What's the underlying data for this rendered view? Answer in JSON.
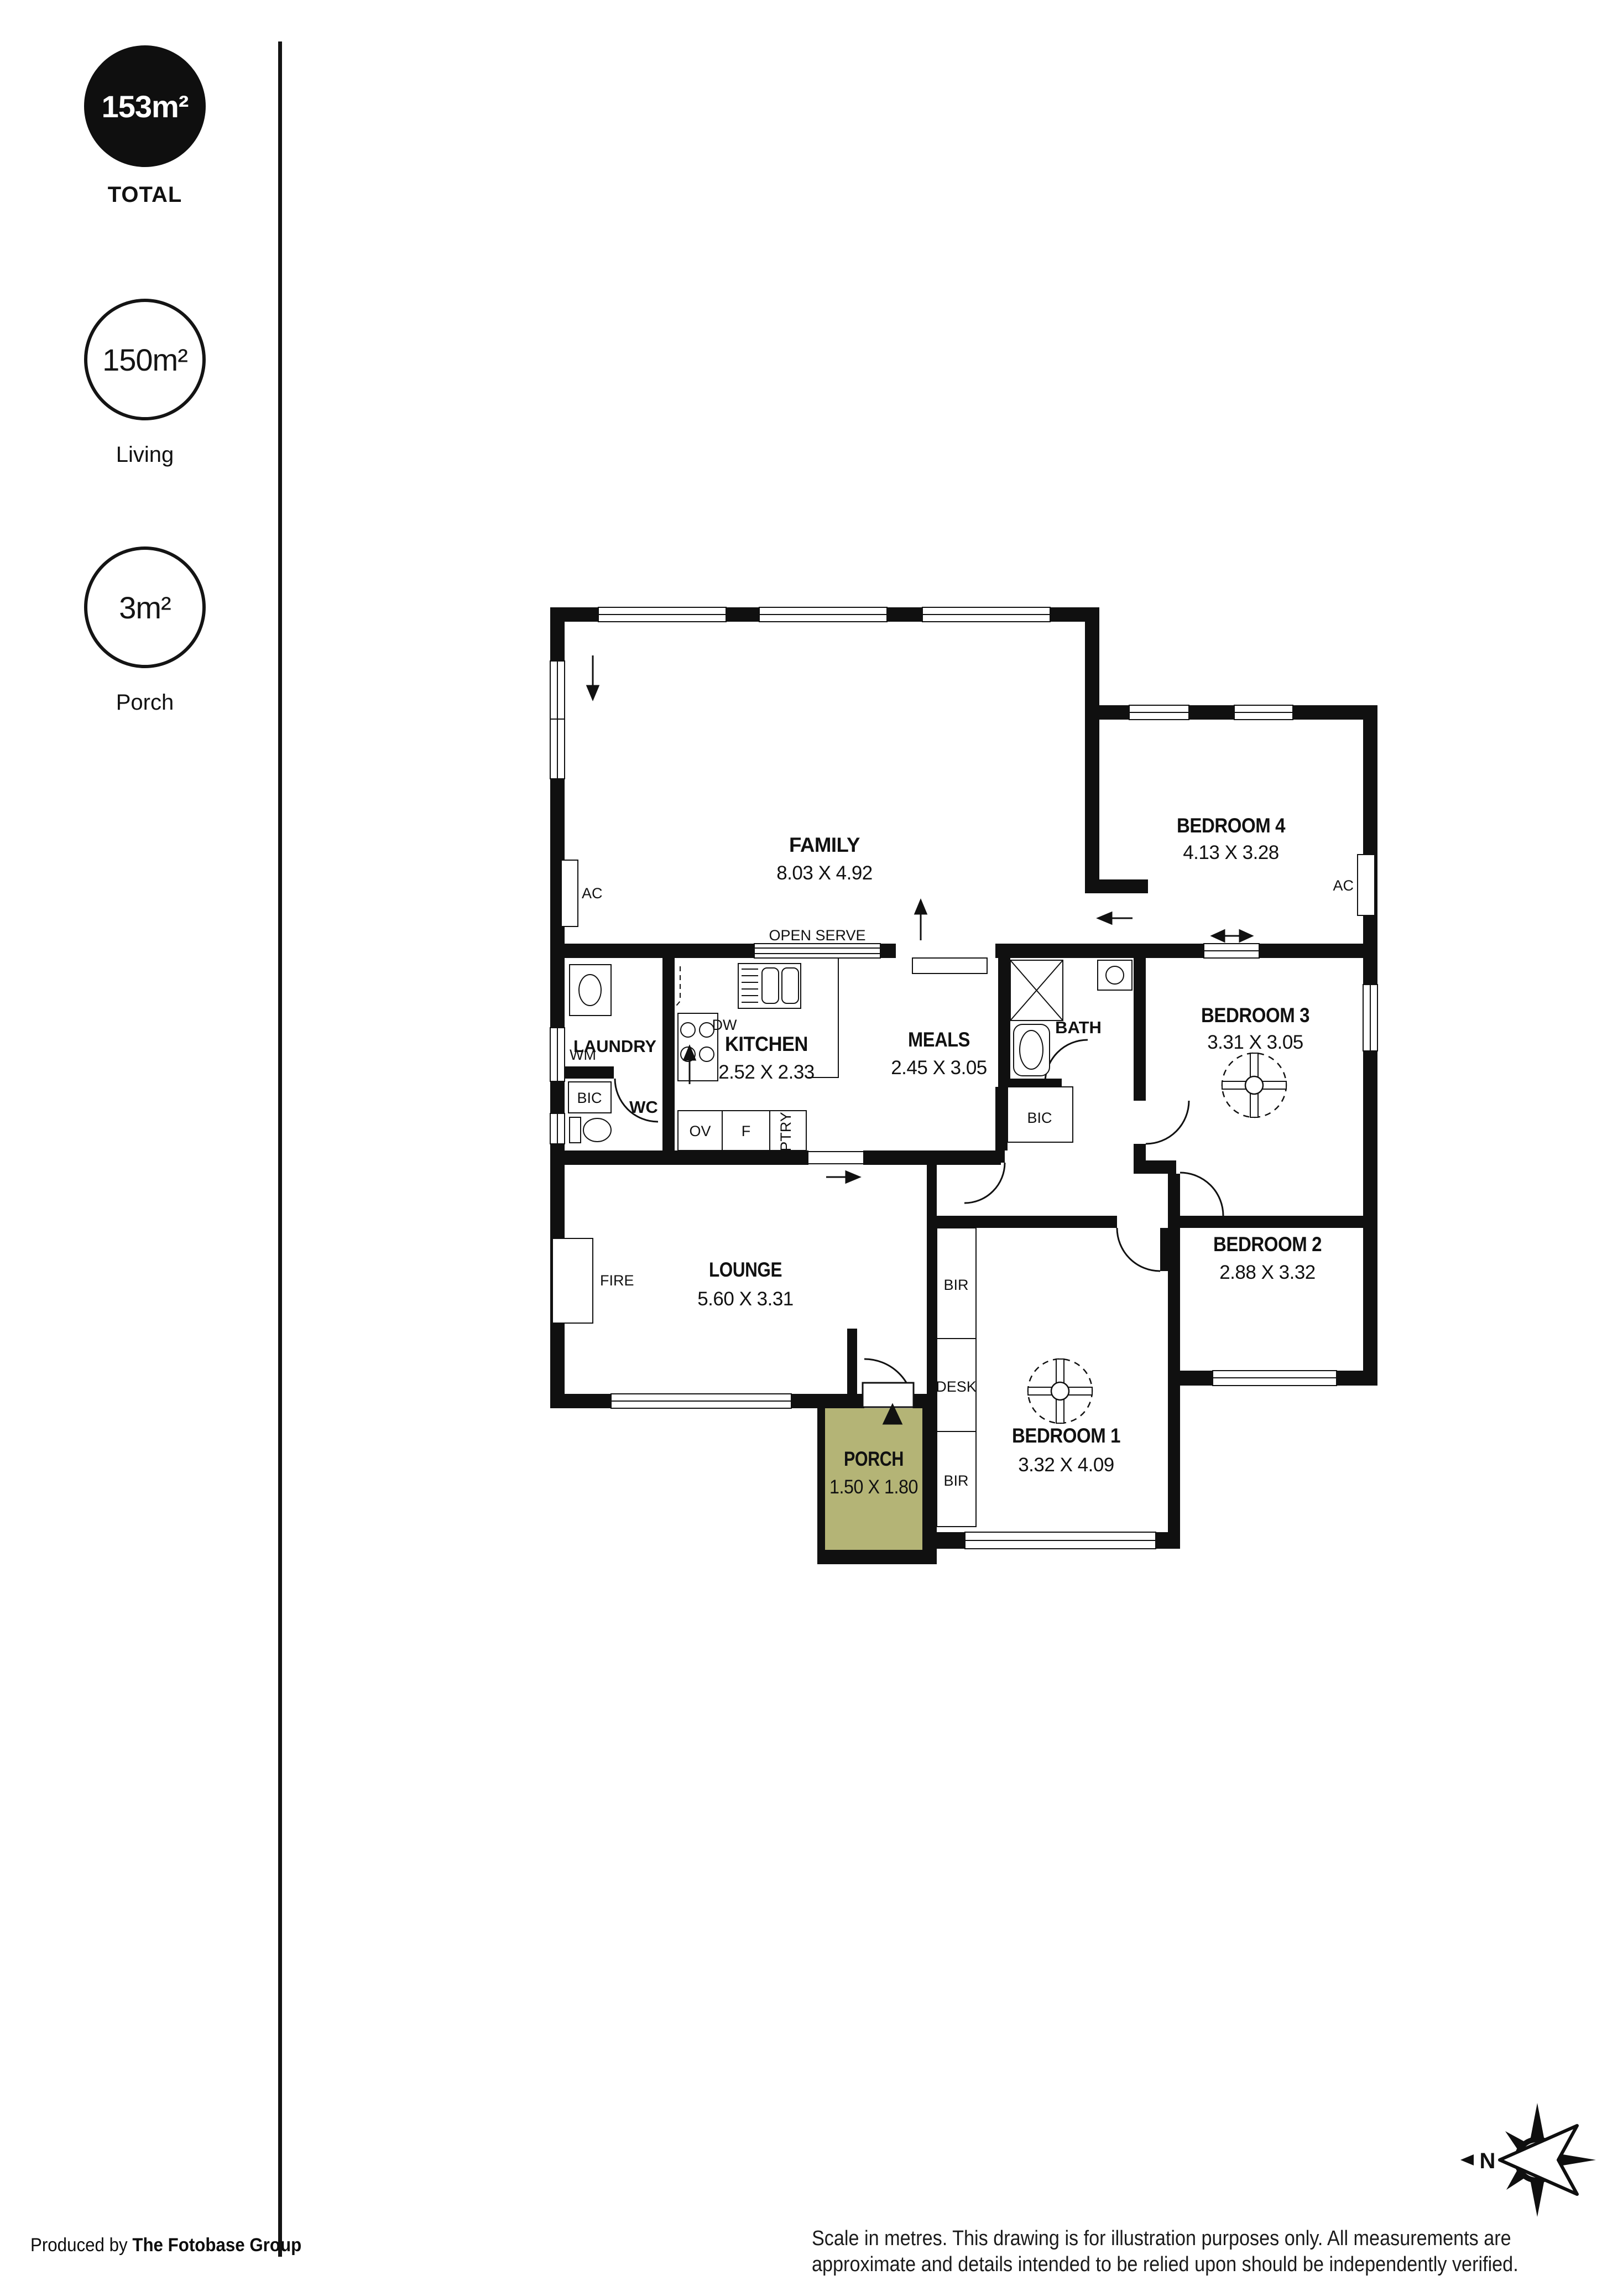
{
  "sidebar": {
    "stats": [
      {
        "value": "153m²",
        "label": "TOTAL"
      },
      {
        "value": "150m²",
        "label": "Living"
      },
      {
        "value": "3m²",
        "label": "Porch"
      }
    ]
  },
  "plan": {
    "rooms": {
      "family": {
        "name": "FAMILY",
        "dims": "8.03 X 4.92"
      },
      "bedroom4": {
        "name": "BEDROOM 4",
        "dims": "4.13 X 3.28"
      },
      "laundry": {
        "name": "LAUNDRY"
      },
      "wc": {
        "name": "WC"
      },
      "kitchen": {
        "name": "KITCHEN",
        "dims": "2.52 X 2.33"
      },
      "meals": {
        "name": "MEALS",
        "dims": "2.45 X 3.05"
      },
      "bath": {
        "name": "BATH"
      },
      "bedroom3": {
        "name": "BEDROOM 3",
        "dims": "3.31 X 3.05"
      },
      "bedroom2": {
        "name": "BEDROOM 2",
        "dims": "2.88 X 3.32"
      },
      "bedroom1": {
        "name": "BEDROOM 1",
        "dims": "3.32 X 4.09"
      },
      "lounge": {
        "name": "LOUNGE",
        "dims": "5.60 X 3.31"
      },
      "porch": {
        "name": "PORCH",
        "dims": "1.50 X 1.80"
      }
    },
    "labels": {
      "open_serve": "OPEN SERVE",
      "ac": "AC",
      "wm": "WM",
      "bic": "BIC",
      "dw": "DW",
      "ov": "OV",
      "fridge": "F",
      "ptry": "PTRY",
      "fire": "FIRE",
      "bir": "BIR",
      "desk": "DESK"
    }
  },
  "compass": {
    "north": "N"
  },
  "footer": {
    "produced_prefix": "Produced by ",
    "produced_brand": "The Fotobase Group",
    "disclaimer_line1": "Scale in metres. This drawing is for illustration purposes only. All measurements are",
    "disclaimer_line2": "approximate and details intended to be relied upon should be independently verified.",
    "porch_fill": "#b4b476"
  }
}
